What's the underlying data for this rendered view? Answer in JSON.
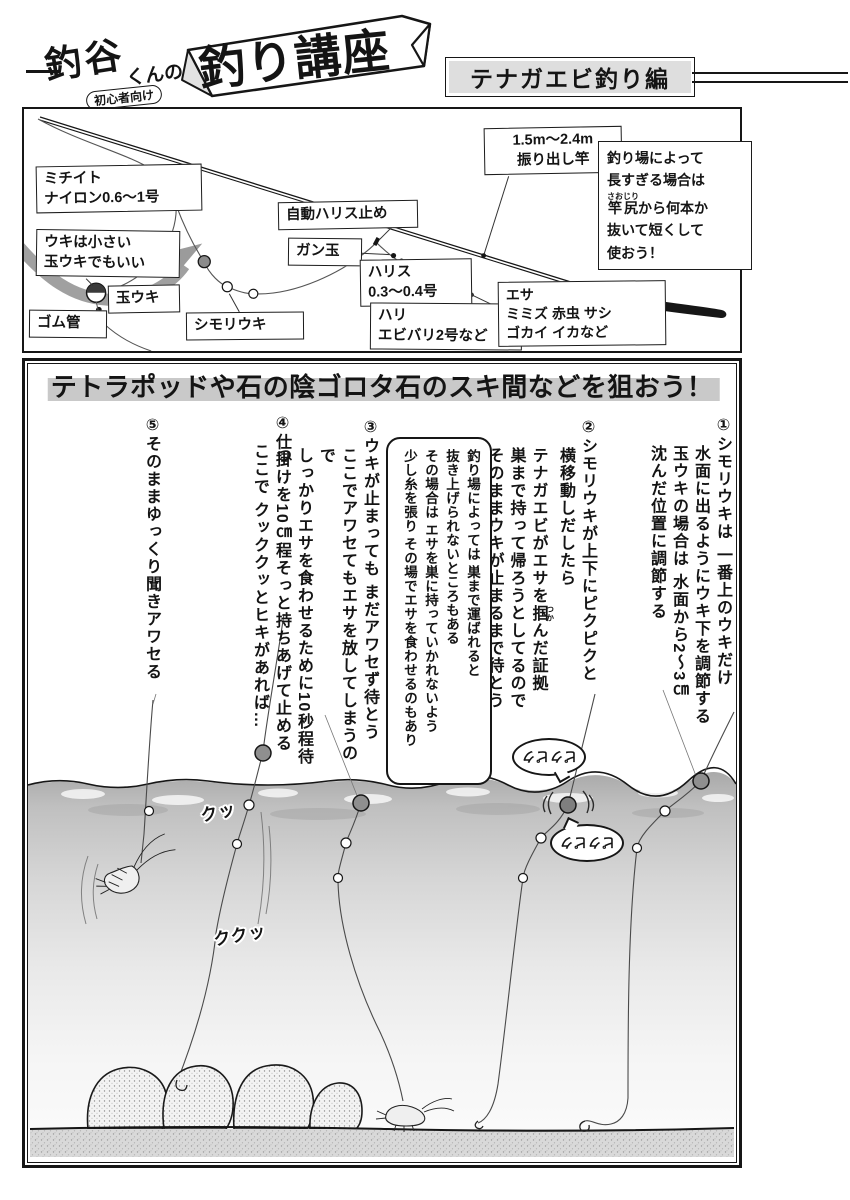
{
  "header": {
    "logo_left": "釣谷",
    "logo_mid": "くんの",
    "logo_main": "釣り講座",
    "logo_sub": "初心者向け",
    "edition": "テナガエビ釣り編"
  },
  "rig": {
    "michiito": "ミチイト\nナイロン0.6〜1号",
    "uki_note": "ウキは小さい\n玉ウキでもいい",
    "tamauki": "玉ウキ",
    "gomukan": "ゴム管",
    "shimoriuki": "シモリウキ",
    "harisu_dome": "自動ハリス止め",
    "gandama": "ガン玉",
    "harisu": "ハリス\n0.3〜0.4号",
    "hari": "ハリ\nエビバリ2号など",
    "esa": "エサ\nミミズ 赤虫 サシ\nゴカイ イカなど",
    "rod_spec": "1.5m〜2.4m\n振り出し竿",
    "rod_note": {
      "l1": "釣り場によって",
      "l2": "長すぎる場合は",
      "l3_base": "竿尻",
      "l3_ruby": "さおじり",
      "l3_rest": "から何本か",
      "l4": "抜いて短くして",
      "l5": "使おう！"
    }
  },
  "guide": {
    "title": "テトラポッドや石の陰ゴロタ石のスキ間などを狙おう！",
    "step1": {
      "l1": "①シモリウキは 一番上のウキだけ",
      "l2": "水面に出るようにウキ下を調節する",
      "l3": "玉ウキの場合は 水面から2〜3㎝",
      "l4": "沈んだ位置に調節する"
    },
    "step2": {
      "l1": "②シモリウキが上下にピクピクと",
      "l2": "横移動しだしたら",
      "l3_pre": "テナガエビがエサを",
      "l3_base": "掴",
      "l3_ruby": "つか",
      "l3_post": "んだ証拠",
      "l4": "巣まで持って帰ろうとしてるので",
      "l5": "そのままウキが止まるまで待とう"
    },
    "step3": {
      "l1": "③ウキが止まっても まだアワセず待とう",
      "l2": "ここでアワセてもエサを放してしまうので",
      "l3": "しっかりエサを食わせるために10秒程待つ"
    },
    "step4": {
      "l1": "④仕掛けを10㎝程そっと持ちあげて止める",
      "l2": "ここで クッククッとヒキがあれば…"
    },
    "step5": {
      "l1": "⑤そのままゆっくり聞きアワセる"
    },
    "note_box": {
      "l1": "釣り場によっては 巣まで運ばれると",
      "l2": "抜き上げられないところもある",
      "l3": "その場合は エサを巣に持っていかれないよう",
      "l4": "少し糸を張り その場でエサを食わせるのもあり"
    },
    "sfx": {
      "pikupiku1": "ピクピク",
      "pikupiku2": "ピクピク",
      "tug_small": "クッ",
      "tug_big": "ククッ"
    }
  }
}
